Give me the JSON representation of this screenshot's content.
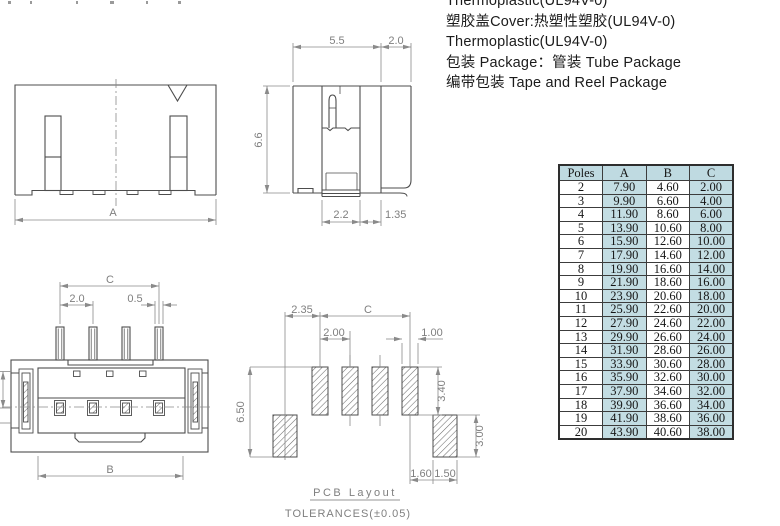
{
  "notes": {
    "line1": "Thermoplastic(UL94V-0)",
    "line2": "塑胶盖Cover:热塑性塑胶(UL94V-0)",
    "line3": "Thermoplastic(UL94V-0)",
    "line4": "包装 Package：管装 Tube Package",
    "line5": "编带包装 Tape and Reel Package"
  },
  "dims": {
    "front": {
      "a": "A"
    },
    "side": {
      "top_left": "5.5",
      "top_right": "2.0",
      "height": "6.6",
      "bottom_left": "2.2",
      "bottom_right": "1.35"
    },
    "bottom": {
      "span": "C",
      "pitch": "2.0",
      "pin_width": "0.5",
      "body": "B"
    },
    "pcb": {
      "offset": "2.35",
      "span": "C",
      "pitch": "2.00",
      "pad_width": "1.00",
      "height_left": "6.50",
      "pad_height": "3.40",
      "side_pad_height": "3.00",
      "gap": "1.60",
      "side_pad_width": "1.50"
    }
  },
  "pcb_caption": {
    "title": "PCB Layout",
    "tolerance": "TOLERANCES(±0.05)"
  },
  "table": {
    "headers": [
      "Poles",
      "A",
      "B",
      "C"
    ],
    "rows": [
      [
        "2",
        "7.90",
        "4.60",
        "2.00"
      ],
      [
        "3",
        "9.90",
        "6.60",
        "4.00"
      ],
      [
        "4",
        "11.90",
        "8.60",
        "6.00"
      ],
      [
        "5",
        "13.90",
        "10.60",
        "8.00"
      ],
      [
        "6",
        "15.90",
        "12.60",
        "10.00"
      ],
      [
        "7",
        "17.90",
        "14.60",
        "12.00"
      ],
      [
        "8",
        "19.90",
        "16.60",
        "14.00"
      ],
      [
        "9",
        "21.90",
        "18.60",
        "16.00"
      ],
      [
        "10",
        "23.90",
        "20.60",
        "18.00"
      ],
      [
        "11",
        "25.90",
        "22.60",
        "20.00"
      ],
      [
        "12",
        "27.90",
        "24.60",
        "22.00"
      ],
      [
        "13",
        "29.90",
        "26.60",
        "24.00"
      ],
      [
        "14",
        "31.90",
        "28.60",
        "26.00"
      ],
      [
        "15",
        "33.90",
        "30.60",
        "28.00"
      ],
      [
        "16",
        "35.90",
        "32.60",
        "30.00"
      ],
      [
        "17",
        "37.90",
        "34.60",
        "32.00"
      ],
      [
        "18",
        "39.90",
        "36.60",
        "34.00"
      ],
      [
        "19",
        "41.90",
        "38.60",
        "36.00"
      ],
      [
        "20",
        "43.90",
        "40.60",
        "38.00"
      ]
    ]
  },
  "colors": {
    "table_shade": "#c3dde3",
    "outline": "#4d4d4d",
    "dimension": "#8a8a8a"
  }
}
